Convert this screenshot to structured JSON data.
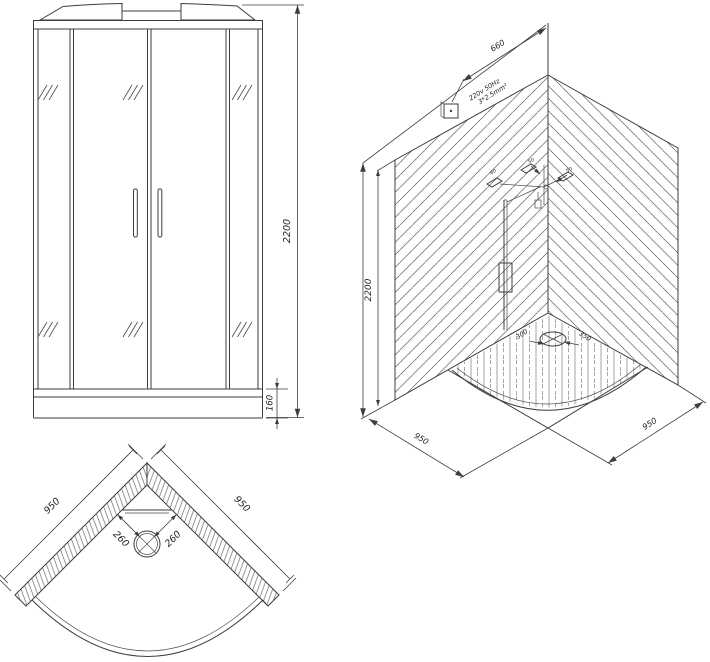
{
  "drawing": {
    "title": "shower-cabin-technical-drawing",
    "background": "#ffffff",
    "line_color": "#3d3d3d",
    "front_view": {
      "height_dim": "2200",
      "tray_height_dim": "160"
    },
    "iso_view": {
      "height_dim": "2200",
      "cable_offset_dim": "660",
      "power_spec_line1": "220v 50Hz",
      "power_spec_line2": "3*2.5mm²",
      "base_left_dim": "950",
      "base_right_dim": "950",
      "drain_offset_left": "300",
      "drain_offset_right": "350",
      "fixture_dim_a": "60",
      "fixture_dim_b": "50",
      "fixture_dim_c": "50"
    },
    "plan_view": {
      "wall_left_dim": "950",
      "wall_right_dim": "950",
      "drain_left_dim": "260",
      "drain_right_dim": "260"
    }
  }
}
